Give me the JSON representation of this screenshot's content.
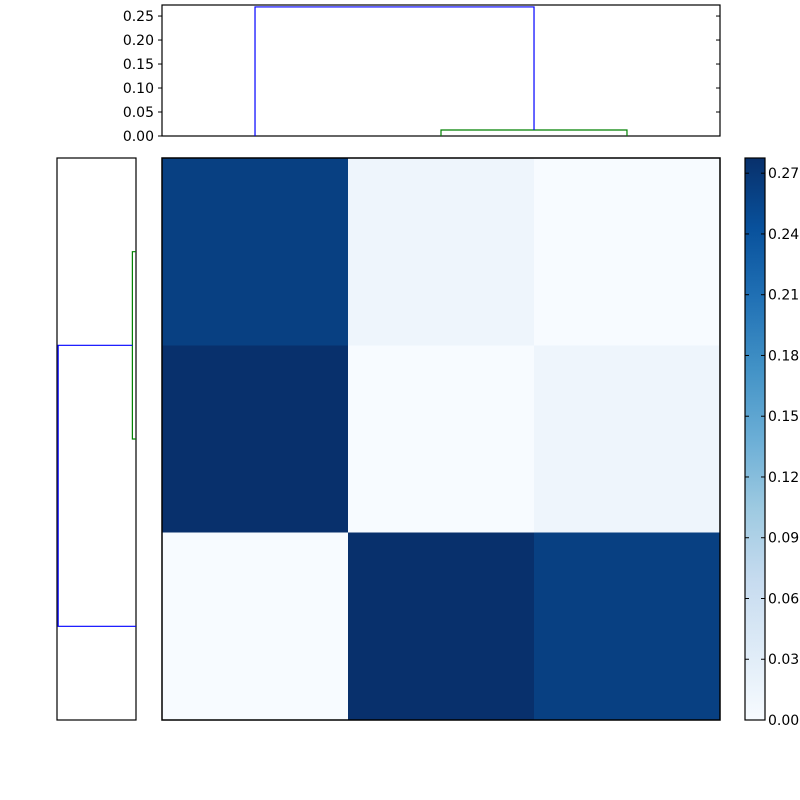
{
  "chart_data": {
    "type": "heatmap",
    "subtype": "clustermap-with-dendrograms",
    "title": "",
    "colormap": {
      "name": "Blues",
      "stops": [
        "#f7fbff",
        "#deebf7",
        "#c6dbef",
        "#9ecae1",
        "#6baed6",
        "#4292c6",
        "#2171b5",
        "#08519c",
        "#08306b"
      ]
    },
    "vmin": 0.0,
    "vmax": 0.2775,
    "matrix": {
      "n_rows": 3,
      "n_cols": 3,
      "values": [
        [
          0.261,
          0.012,
          0.0
        ],
        [
          0.277,
          0.0,
          0.012
        ],
        [
          0.0,
          0.277,
          0.261
        ]
      ]
    },
    "top_dendrogram": {
      "ylim": [
        0.0,
        0.273
      ],
      "tick_labels": [
        "0.00",
        "0.05",
        "0.10",
        "0.15",
        "0.20",
        "0.25"
      ],
      "tick_values": [
        0.0,
        0.05,
        0.1,
        0.15,
        0.2,
        0.25
      ],
      "links": [
        {
          "name": "green-cluster-link",
          "color": "#008000",
          "x": [
            0.5,
            0.5,
            0.8333,
            0.8333
          ],
          "heights": [
            0.0,
            0.0125,
            0.0125,
            0.0
          ]
        },
        {
          "name": "blue-root-link",
          "color": "#0000ff",
          "x": [
            0.1667,
            0.1667,
            0.6667,
            0.6667
          ],
          "heights": [
            0.0,
            0.269,
            0.269,
            0.0125
          ]
        }
      ]
    },
    "left_dendrogram": {
      "xlim": [
        0.0,
        0.273
      ],
      "links": [
        {
          "name": "green-cluster-link",
          "color": "#008000",
          "y": [
            0.1667,
            0.1667,
            0.5,
            0.5
          ],
          "heights": [
            0.0,
            0.0125,
            0.0125,
            0.0
          ]
        },
        {
          "name": "blue-root-link",
          "color": "#0000ff",
          "y": [
            0.3333,
            0.3333,
            0.8333,
            0.8333
          ],
          "heights": [
            0.0125,
            0.269,
            0.269,
            0.0
          ]
        }
      ]
    },
    "colorbar": {
      "orientation": "vertical",
      "tick_labels": [
        "0.00",
        "0.03",
        "0.06",
        "0.09",
        "0.12",
        "0.15",
        "0.18",
        "0.21",
        "0.24",
        "0.27"
      ],
      "tick_values": [
        0.0,
        0.03,
        0.06,
        0.09,
        0.12,
        0.15,
        0.18,
        0.21,
        0.24,
        0.27
      ]
    }
  },
  "colors": {
    "background": "#ffffff",
    "axes_edge": "#000000",
    "tick_label": "#000000"
  }
}
